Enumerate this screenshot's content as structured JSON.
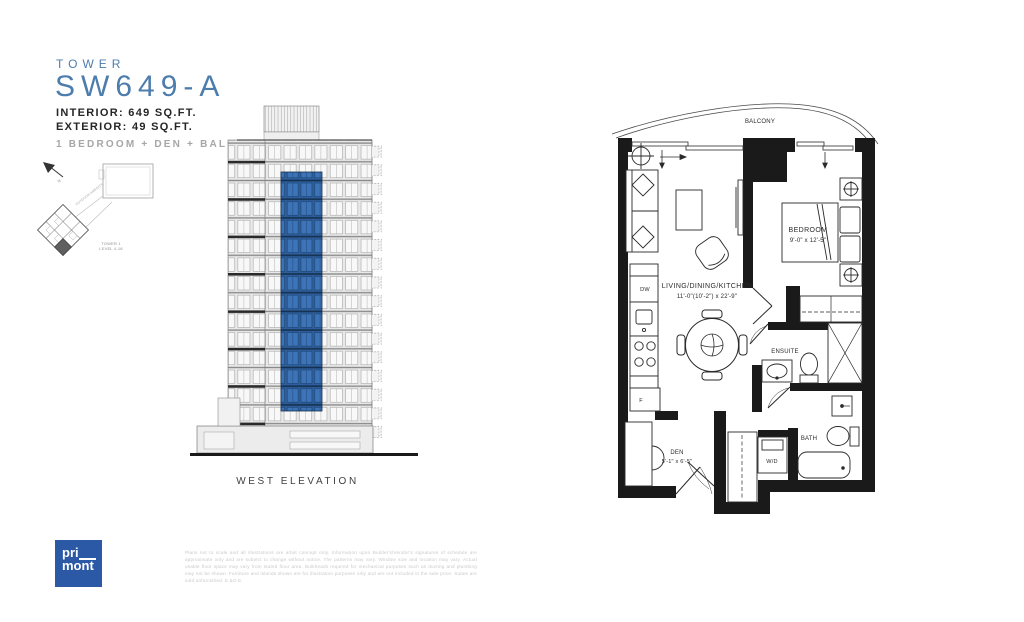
{
  "header": {
    "eyebrow": "TOWER",
    "unit_name": "SW649-A",
    "interior": "INTERIOR: 649 SQ.FT.",
    "exterior": "EXTERIOR: 49 SQ.FT.",
    "layout": "1 BEDROOM + DEN + BALCONY"
  },
  "keyplan": {
    "north_label": "N",
    "amenity_label": "OUTDOOR AMENITY",
    "tower_label": "TOWER 1",
    "level_label": "LEVEL 4-18"
  },
  "elevation": {
    "caption": "WEST ELEVATION",
    "highlight_color": "#2d5f9e"
  },
  "floorplan": {
    "balcony": "BALCONY",
    "living_name": "LIVING/DINING/KITCHEN",
    "living_dims": "11'-0\"(10'-2\") x 22'-9\"",
    "bedroom_name": "BEDROOM",
    "bedroom_dims": "9'-0\" x 12'-5\"",
    "den_name": "DEN",
    "den_dims": "5'-1\" x 6'-5\"",
    "ensuite": "ENSUITE",
    "bath": "BATH",
    "washer_dryer": "W/D",
    "fridge": "F",
    "dishwasher": "DW"
  },
  "footer": {
    "logo_line1": "pri",
    "logo_line2": "mont",
    "logo_color": "#2b59a5",
    "disclaimer": "Plans not to scale and all illustrations are artist concept only. Information upon Builder's/Vendor's signatures of schedule are approximate only and are subject to change without notice. The patterns may vary. Window size and location may vary. Actual usable floor space may vary from stated floor area. Bulkheads required for mechanical purposes such as ducting and plumbing may not be shown. Furniture and islands shown are for illustration purposes only and are not included in the sale price. Suites are sold unfurnished. E.&O.E."
  },
  "colors": {
    "accent_blue": "#4d7dad",
    "elevation_blue": "#2d5f9e",
    "logo_blue": "#2b59a5",
    "text_dark": "#262626",
    "text_gray": "#a6a6a6"
  }
}
